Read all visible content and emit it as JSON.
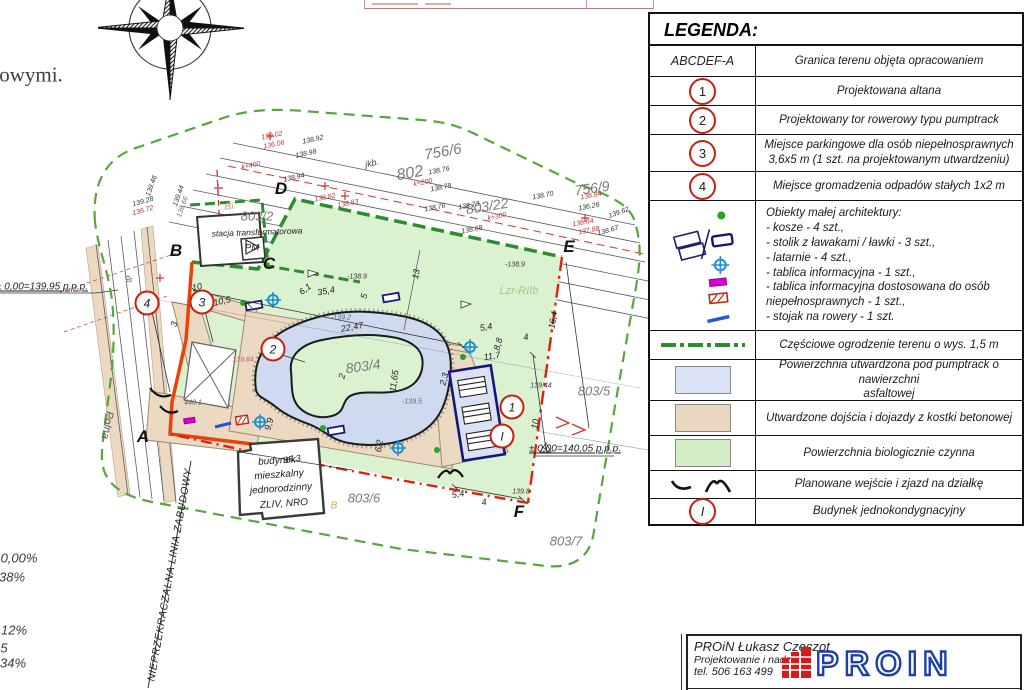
{
  "page_fragments": {
    "left_paragraph": "owymi.",
    "bottom_left_values": [
      {
        "t": "0,00%",
        "x": 19,
        "y": 558
      },
      {
        "t": "38%",
        "x": 12,
        "y": 577
      },
      {
        "t": "12%",
        "x": 14,
        "y": 630
      },
      {
        "t": "5",
        "x": 4,
        "y": 648
      },
      {
        "t": "34%",
        "x": 13,
        "y": 663
      }
    ]
  },
  "plan": {
    "corner_letters": [
      {
        "t": "A",
        "x": 143,
        "y": 437
      },
      {
        "t": "B",
        "x": 176,
        "y": 251
      },
      {
        "t": "C",
        "x": 269,
        "y": 264
      },
      {
        "t": "D",
        "x": 281,
        "y": 189
      },
      {
        "t": "E",
        "x": 569,
        "y": 247
      },
      {
        "t": "F",
        "x": 519,
        "y": 512
      }
    ],
    "markers": [
      {
        "t": "4",
        "x": 147,
        "y": 303
      },
      {
        "t": "3",
        "x": 202,
        "y": 302
      },
      {
        "t": "2",
        "x": 273,
        "y": 349
      },
      {
        "t": "1",
        "x": 512,
        "y": 407
      },
      {
        "t": "I",
        "x": 502,
        "y": 436
      }
    ],
    "parcels": [
      {
        "t": "756/6",
        "x": 443,
        "y": 152,
        "r": -10,
        "s": 15
      },
      {
        "t": "802",
        "x": 410,
        "y": 174,
        "r": -10,
        "s": 16
      },
      {
        "t": "756/9",
        "x": 592,
        "y": 188,
        "r": -8,
        "s": 14
      },
      {
        "t": "803/22",
        "x": 487,
        "y": 206,
        "r": -9,
        "s": 14
      },
      {
        "t": "803/2",
        "x": 257,
        "y": 216,
        "s": 13
      },
      {
        "t": "803/4",
        "x": 363,
        "y": 366,
        "r": -8,
        "s": 14
      },
      {
        "t": "803/5",
        "x": 594,
        "y": 391,
        "s": 13
      },
      {
        "t": "803/6",
        "x": 364,
        "y": 498,
        "s": 13
      },
      {
        "t": "803/7",
        "x": 566,
        "y": 541,
        "s": 13
      }
    ],
    "dimensions": [
      {
        "t": "10",
        "x": 197,
        "y": 287,
        "r": -13
      },
      {
        "t": "10,5",
        "x": 222,
        "y": 301,
        "r": -13
      },
      {
        "t": "35,4",
        "x": 326,
        "y": 291,
        "r": -10
      },
      {
        "t": "6,1",
        "x": 305,
        "y": 289,
        "r": -38
      },
      {
        "t": "5",
        "x": 364,
        "y": 296,
        "r": -75
      },
      {
        "t": "13",
        "x": 416,
        "y": 274,
        "r": -78
      },
      {
        "t": "22,47",
        "x": 352,
        "y": 327,
        "r": -10
      },
      {
        "t": "2",
        "x": 342,
        "y": 376,
        "r": -75
      },
      {
        "t": "11,65",
        "x": 394,
        "y": 381,
        "r": -82
      },
      {
        "t": "5,4",
        "x": 486,
        "y": 327,
        "r": -10
      },
      {
        "t": "4",
        "x": 526,
        "y": 337,
        "r": -10
      },
      {
        "t": "8,8",
        "x": 498,
        "y": 344,
        "r": -75
      },
      {
        "t": "11,7",
        "x": 492,
        "y": 356,
        "r": -10
      },
      {
        "t": "2,3",
        "x": 444,
        "y": 379,
        "r": -75
      },
      {
        "t": "9,9",
        "x": 269,
        "y": 424,
        "r": -75
      },
      {
        "t": "6,2",
        "x": 379,
        "y": 446,
        "r": -80
      },
      {
        "t": "35,3",
        "x": 292,
        "y": 459,
        "r": -8
      },
      {
        "t": "16,4",
        "x": 553,
        "y": 320,
        "r": -80
      },
      {
        "t": "10",
        "x": 535,
        "y": 424,
        "r": -80
      },
      {
        "t": "5,4",
        "x": 458,
        "y": 494,
        "r": -9
      },
      {
        "t": "4",
        "x": 484,
        "y": 502,
        "r": -9
      },
      {
        "t": "3",
        "x": 174,
        "y": 324,
        "r": -75
      }
    ],
    "elevations": [
      {
        "t": "138.92",
        "x": 313,
        "y": 140,
        "r": -12
      },
      {
        "t": "138.98",
        "x": 306,
        "y": 154,
        "r": -12
      },
      {
        "t": "138.94",
        "x": 294,
        "y": 178,
        "r": -12
      },
      {
        "t": "138.76",
        "x": 439,
        "y": 171,
        "r": -11
      },
      {
        "t": "138.79",
        "x": 441,
        "y": 188,
        "r": -11
      },
      {
        "t": "138.76",
        "x": 435,
        "y": 208,
        "r": -11
      },
      {
        "t": "138.70",
        "x": 543,
        "y": 196,
        "r": -11
      },
      {
        "t": "138.73",
        "x": 469,
        "y": 206,
        "r": -11
      },
      {
        "t": "138.68",
        "x": 472,
        "y": 230,
        "r": -11
      },
      {
        "t": "136.26",
        "x": 589,
        "y": 207,
        "r": -11
      },
      {
        "t": "139.62",
        "x": 619,
        "y": 213,
        "r": -20
      },
      {
        "t": "138.67",
        "x": 608,
        "y": 231,
        "r": -15
      },
      {
        "t": "138.84",
        "x": 591,
        "y": 196,
        "r": -11,
        "c": "#c03333"
      },
      {
        "t": "138.64",
        "x": 583,
        "y": 223,
        "r": -11,
        "c": "#c03333"
      },
      {
        "t": "137.88",
        "x": 589,
        "y": 231,
        "r": -11,
        "c": "#c03333"
      },
      {
        "t": "138.82",
        "x": 325,
        "y": 198,
        "r": -11,
        "c": "#c03333"
      },
      {
        "t": "138.83",
        "x": 348,
        "y": 204,
        "r": -11,
        "c": "#c03333"
      },
      {
        "t": "139.02",
        "x": 272,
        "y": 136,
        "r": -11,
        "c": "#c03333"
      },
      {
        "t": "136.06",
        "x": 274,
        "y": 145,
        "r": -11,
        "c": "#c03333"
      },
      {
        "t": "139.28",
        "x": 143,
        "y": 202,
        "r": -15
      },
      {
        "t": "136.72",
        "x": 143,
        "y": 211,
        "r": -15,
        "c": "#c03333"
      },
      {
        "t": "139.46",
        "x": 152,
        "y": 186,
        "r": -70
      },
      {
        "t": "139.44",
        "x": 179,
        "y": 196,
        "r": -70
      },
      {
        "t": "136.66",
        "x": 183,
        "y": 207,
        "r": -70,
        "c": "#777777"
      },
      {
        "t": "-138.9",
        "x": 357,
        "y": 277
      },
      {
        "t": "-138.9",
        "x": 515,
        "y": 265
      },
      {
        "t": "-139.2",
        "x": 341,
        "y": 318,
        "c": "#556677"
      },
      {
        "t": "-139.5",
        "x": 412,
        "y": 402,
        "c": "#556677"
      },
      {
        "t": "139.84",
        "x": 243,
        "y": 360,
        "c": "#b06060"
      },
      {
        "t": "139.44",
        "x": 541,
        "y": 386
      },
      {
        "t": "139.8",
        "x": 521,
        "y": 492
      },
      {
        "t": "440.1",
        "x": 193,
        "y": 403,
        "c": "#555555"
      },
      {
        "t": "k+200",
        "x": 423,
        "y": 183,
        "r": -11,
        "c": "#c03333"
      },
      {
        "t": "k+300",
        "x": 497,
        "y": 217,
        "r": -11,
        "c": "#c03333"
      },
      {
        "t": "k+400",
        "x": 251,
        "y": 166,
        "r": -11,
        "c": "#c03333"
      }
    ],
    "notes": [
      {
        "t": "± 0,00=139,95 p.p.p.",
        "x": 42,
        "y": 287,
        "s": 10,
        "u": 1
      },
      {
        "t": "± 0,00=140,05 p.p.p.",
        "x": 575,
        "y": 449,
        "s": 10,
        "u": 1
      },
      {
        "t": "stacja transformatorowa",
        "x": 257,
        "y": 232,
        "s": 8.5,
        "r": -2
      },
      {
        "t": "PM",
        "x": 252,
        "y": 248,
        "s": 9.5
      },
      {
        "t": "budynek",
        "x": 277,
        "y": 461,
        "s": 10,
        "r": -4
      },
      {
        "t": "mieszkalny",
        "x": 279,
        "y": 475,
        "s": 10,
        "r": -4
      },
      {
        "t": "jednorodzinny",
        "x": 281,
        "y": 489,
        "s": 10,
        "r": -4
      },
      {
        "t": "ZLIV, NRO",
        "x": 284,
        "y": 504,
        "s": 10,
        "r": -4
      },
      {
        "t": "NIEPRZEKRACZALNA LINIA ZABUDOWY",
        "x": 170,
        "y": 575,
        "s": 10.5,
        "r": -80,
        "ls": 0.5
      },
      {
        "t": "Polna",
        "x": 107,
        "y": 425,
        "s": 11,
        "r": 100,
        "c": "#555555"
      },
      {
        "t": "dr",
        "x": 129,
        "y": 279,
        "s": 9,
        "r": 72,
        "c": "#666666"
      },
      {
        "t": "jkb.",
        "x": 372,
        "y": 163,
        "s": 9,
        "r": -12,
        "c": "#444444"
      },
      {
        "t": "Bi",
        "x": 229,
        "y": 207,
        "s": 10,
        "c": "#c9a84c"
      },
      {
        "t": "B",
        "x": 334,
        "y": 506,
        "s": 10,
        "c": "#c9a84c"
      },
      {
        "t": "Lzr-RIIb",
        "x": 519,
        "y": 291,
        "s": 11,
        "c": "#9ccf84"
      }
    ]
  },
  "legend": {
    "title": "LEGENDA:",
    "rows": [
      {
        "type": "text",
        "symbol": "ABCDEF-A",
        "desc": [
          "Granica terenu objęta opracowaniem"
        ]
      },
      {
        "type": "circle",
        "symbol": "1",
        "desc": [
          "Projektowana altana"
        ]
      },
      {
        "type": "circle",
        "symbol": "2",
        "desc": [
          "Projektowany tor rowerowy typu pumptrack"
        ]
      },
      {
        "type": "circle",
        "symbol": "3",
        "desc": [
          "Miejsce parkingowe dla osób niepełnosprawnych",
          "3,6x5 m (1 szt. na projektowanym utwardzeniu)"
        ]
      },
      {
        "type": "circle",
        "symbol": "4",
        "desc": [
          "Miejsce gromadzenia odpadów stałych 1x2 m"
        ]
      },
      {
        "type": "objects",
        "desc": [
          "Obiekty małej architektury:",
          "- kosze - 4 szt.,",
          "- stolik z ławakami / ławki - 3 szt.,",
          "- latarnie - 4 szt.,",
          "- tablica informacyjna - 1 szt.,",
          "- tablica informacyjna dostosowana do osób",
          "niepełnosprawnych - 1 szt.,",
          "- stojak na rowery - 1 szt."
        ]
      },
      {
        "type": "fence",
        "desc": [
          "Częściowe ogrodzenie terenu o wys. 1,5 m"
        ]
      },
      {
        "type": "swatch",
        "color": "#dbe4f7",
        "desc": [
          "Powierzchnia utwardzona pod pumptrack o nawierzchni",
          "asfaltowej"
        ]
      },
      {
        "type": "swatch",
        "color": "#ead7bf",
        "desc": [
          "Utwardzone dojścia i dojazdy z kostki betonowej"
        ]
      },
      {
        "type": "swatch",
        "color": "#d3eec7",
        "desc": [
          "Powierzchnia biologicznie czynna"
        ]
      },
      {
        "type": "arcs",
        "desc": [
          "Planowane wejście i zjazd na działkę"
        ]
      },
      {
        "type": "circle",
        "symbol": "I",
        "desc": [
          "Budynek jednokondygnacyjny"
        ]
      }
    ]
  },
  "titleblock": {
    "company": "PROiN Łukasz Czeczot",
    "subtitle": "Projektowanie i nadzór",
    "phone": "tel. 506 163 499",
    "logo_text": "PROIN",
    "doc_title": "PROJEKT ZAGOSPODAROWANIA DZIAŁKI"
  }
}
